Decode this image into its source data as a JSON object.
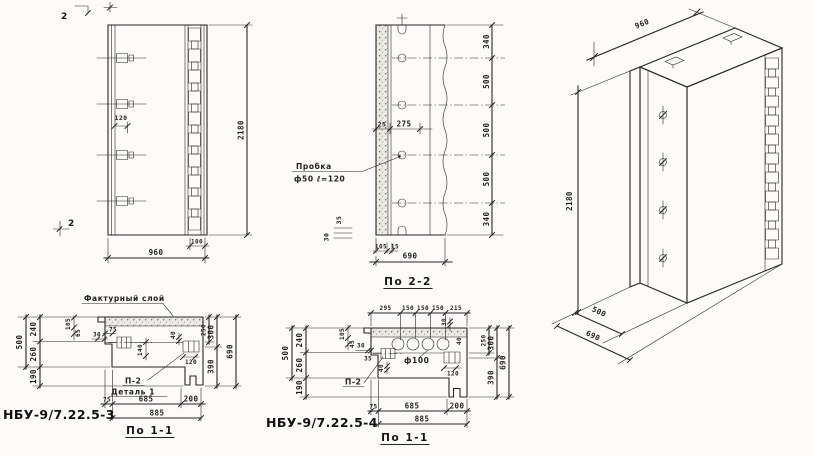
{
  "palette": {
    "ink": "#262626",
    "paper": "#fcfbf9"
  },
  "front_view": {
    "marker_top": "2",
    "marker_bottom": "2",
    "dim_anchor_spacing": "120",
    "dim_height": "2180",
    "dim_width": "960",
    "dim_channel_offset": "100"
  },
  "section_2_2": {
    "caption": "По 2-2",
    "plug_label_title": "Пробка",
    "plug_label_spec": "ф50 ℓ=120",
    "dim_25": "25",
    "dim_275": "275",
    "right_dims": [
      "340",
      "500",
      "500",
      "500",
      "340"
    ],
    "dim_35": "35",
    "dim_30": "30",
    "dim_105": "105",
    "dim_15": "15",
    "dim_width": "690"
  },
  "iso_view": {
    "dim_height": "2180",
    "dim_width": "960",
    "dim_500": "500",
    "dim_depth": "690"
  },
  "detail_3": {
    "title": "НБУ-9/7.22.5-3",
    "caption": "По 1-1",
    "facing_layer_label": "Фактурный слой",
    "node_label": "П-2",
    "detail_label": "Деталь 1",
    "dim_500": "500",
    "dim_240": "240",
    "dim_260": "260",
    "dim_190": "190",
    "dim_105": "105",
    "dim_65": "65",
    "dim_30": "30",
    "dim_75": "75",
    "dim_140": "140",
    "dim_40": "40",
    "dim_120": "120",
    "dim_250": "250",
    "dim_300": "300",
    "dim_390": "390",
    "dim_690": "690",
    "dim_b75": "75",
    "dim_685": "685",
    "dim_200": "200",
    "dim_885": "885"
  },
  "detail_4": {
    "title": "НБУ-9/7.22.5-4",
    "caption": "По 1-1",
    "node_label": "П-2",
    "hole_label": "ф100",
    "top_dims": [
      "295",
      "150",
      "150",
      "150",
      "215"
    ],
    "dim_500": "500",
    "dim_240": "240",
    "dim_260": "260",
    "dim_190": "190",
    "dim_105": "105",
    "dim_45": "45",
    "dim_30": "30",
    "dim_35": "35",
    "dim_40": "40",
    "dim_r30": "30",
    "dim_r40": "40",
    "dim_120": "120",
    "dim_250": "250",
    "dim_300": "300",
    "dim_390": "390",
    "dim_690": "690",
    "dim_b75": "75",
    "dim_685": "685",
    "dim_200": "200",
    "dim_885": "885"
  }
}
